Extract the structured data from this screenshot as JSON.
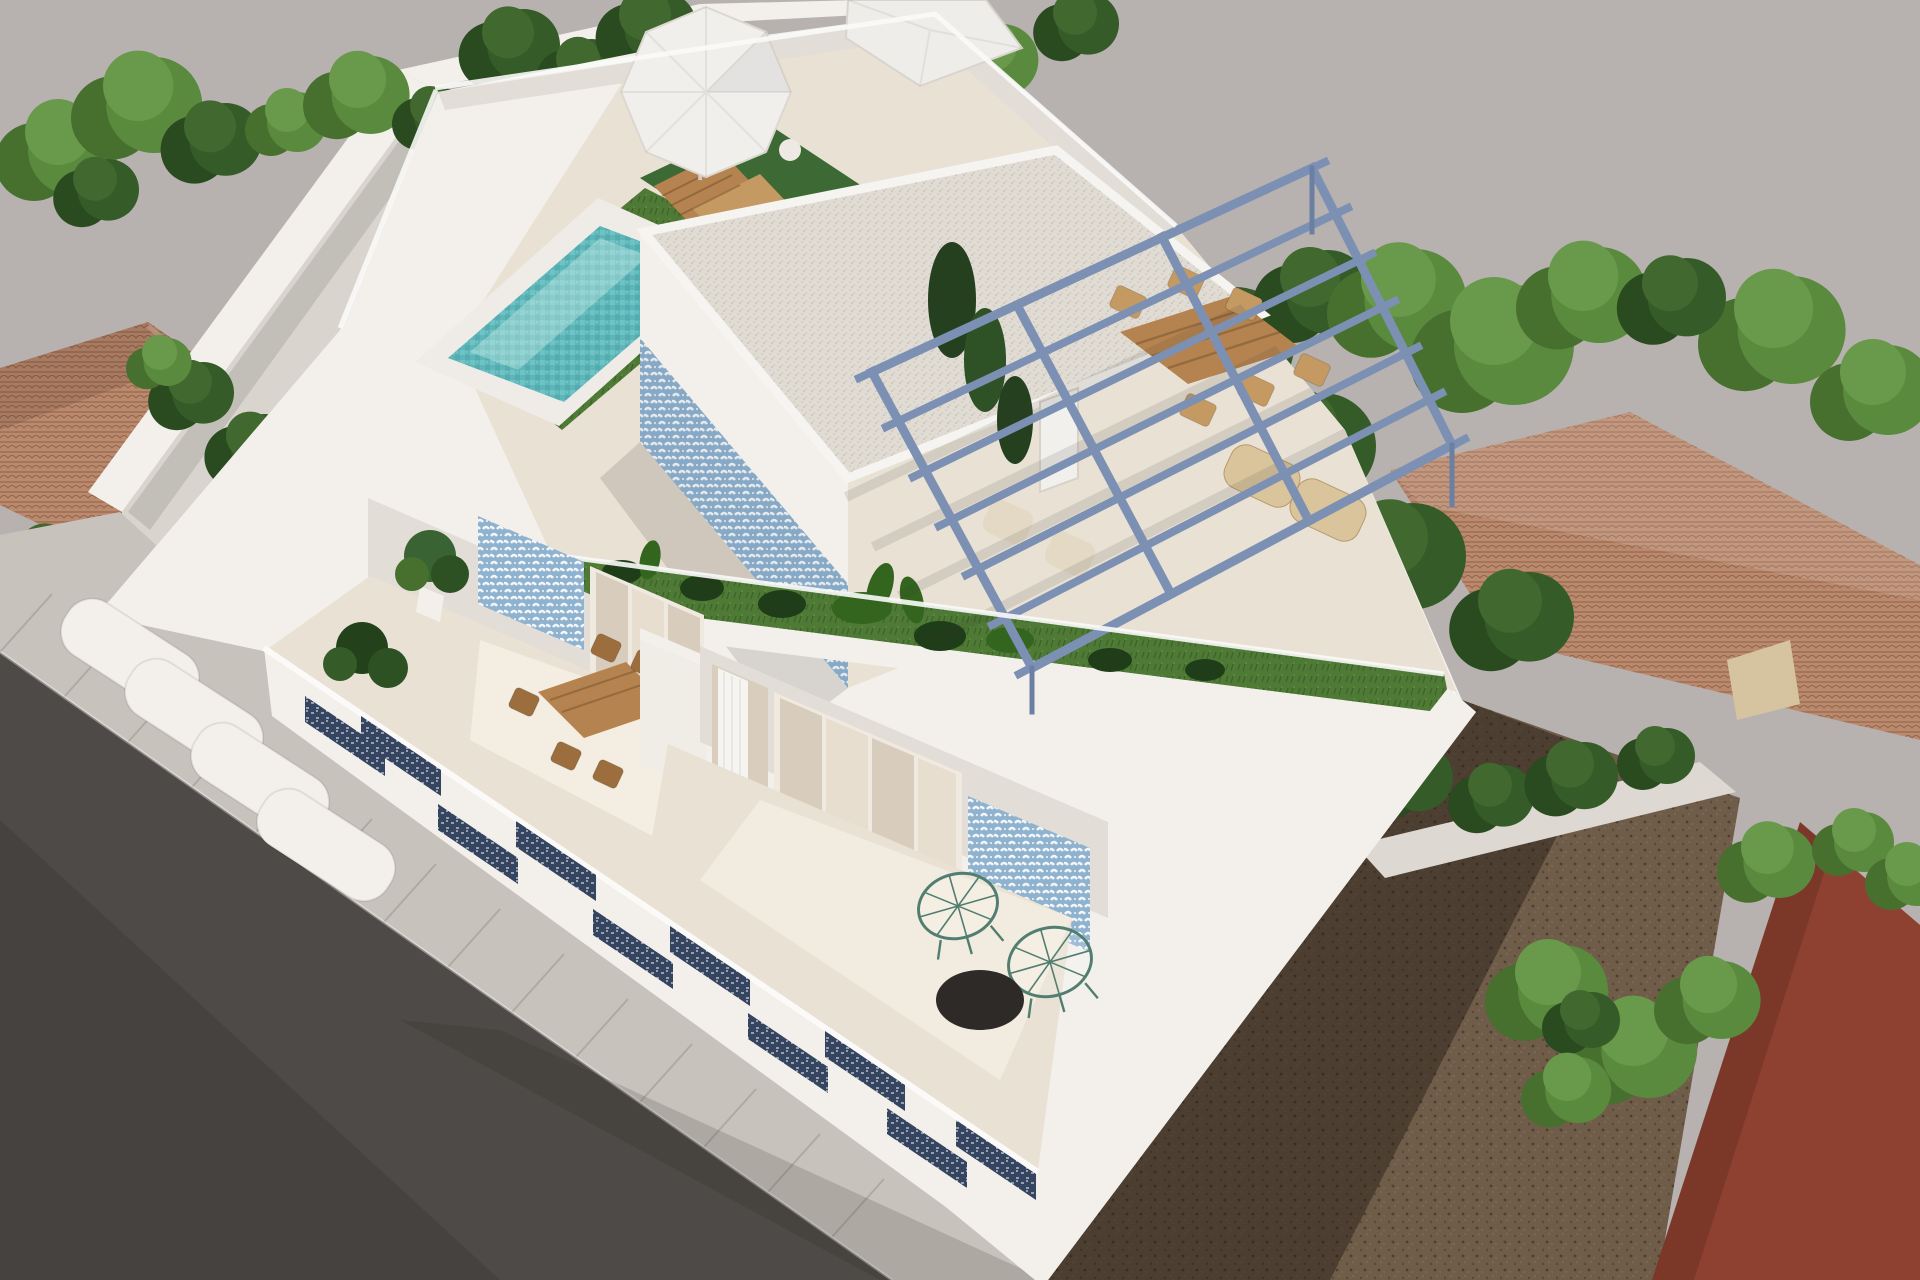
{
  "scene": {
    "title": "Aerial 3D architectural render of a modern white villa with rooftop pool terrace",
    "view": "high-angle three-quarter aerial view",
    "medium": "architectural visualization render",
    "setting": "urban infill plot between neighbouring tiled-roof houses, asphalt street at lower left, vacant dirt lot at lower right"
  },
  "palette": {
    "bg": "#b7b2b0",
    "road": "#4e4a47",
    "sidewalk": "#c8c2bc",
    "white_lit": "#f3f0ec",
    "white_shade": "#e2ddd6",
    "cream_floor": "#e9e1d4",
    "courtyard": "#d9d4cd",
    "pool_coping": "#efece7",
    "pool_water": "#5fb6b9",
    "pool_water_light": "#8fd4d2",
    "lawn": "#4e7a36",
    "lawn_dark": "#3c6128",
    "rug_green": "#3d6a34",
    "tile_blue": "#8fb2cf",
    "tile_motif_white": "#f2f6f9",
    "navy_tile": "#35445f",
    "pergola": "#7c90b3",
    "gravel": "#e0dbd3",
    "wood": "#b5834f",
    "wood_light": "#c49a62",
    "wicker": "#d9c49c",
    "tree_light": "#5a8a3e",
    "tree_mid": "#47702f",
    "tree_dark": "#2a4b20",
    "roof_tile": "#b98a6e",
    "roof_tile_line": "#96644a",
    "dirt": "#6f5c49",
    "red_building": "#8e4130",
    "boundary_wall": "#ddd8d1",
    "curtain": "#f6f4f1",
    "glass_dark": "#d8cdbd",
    "glass_light": "#e8decf",
    "table_black": "#2d2a28"
  },
  "rooftop": {
    "pool": {
      "shape": "rectangular",
      "water_tones": 2,
      "steps": 3,
      "coping": "white"
    },
    "penthouse": {
      "roof_finish": "white gravel",
      "accent_wall": "blue patterned tiles",
      "doors": 1
    },
    "pergola": {
      "material": "steel",
      "color_name": "slate blue",
      "beams": 7,
      "cross_rails": 2
    },
    "umbrellas": 2,
    "sun_loungers": 2,
    "outdoor_rug": 1,
    "dining_table_seats": 6,
    "wicker_lounge_chairs": 2,
    "lawn_patches": 3,
    "planter_strip_plants": "tropical leaves"
  },
  "first_floor": {
    "dining_terrace": {
      "table": 1,
      "chairs": 6,
      "potted_plant": 1,
      "tile_panel": "blue pattern",
      "sliding_glass_door": 1
    },
    "lounge_terrace": {
      "acapulco_chairs": 2,
      "round_black_table": 1,
      "white_curtain": 1,
      "tile_panel": "blue pattern",
      "glass_panes": 4
    }
  },
  "street_level": {
    "balcony_openings_navy_tile": 10,
    "curved_parapets": 4,
    "sidewalk_joint_lines": 14
  },
  "surroundings": {
    "left_neighbor": "terracotta hip roof with trees",
    "right_neighbor": "large terracotta tiled roofs among trees",
    "dirt_lot": "brown vacant ground with building shadow",
    "corner_building": "dark red-brown facade",
    "boundary_walls": "white",
    "tree_clusters": 20
  }
}
